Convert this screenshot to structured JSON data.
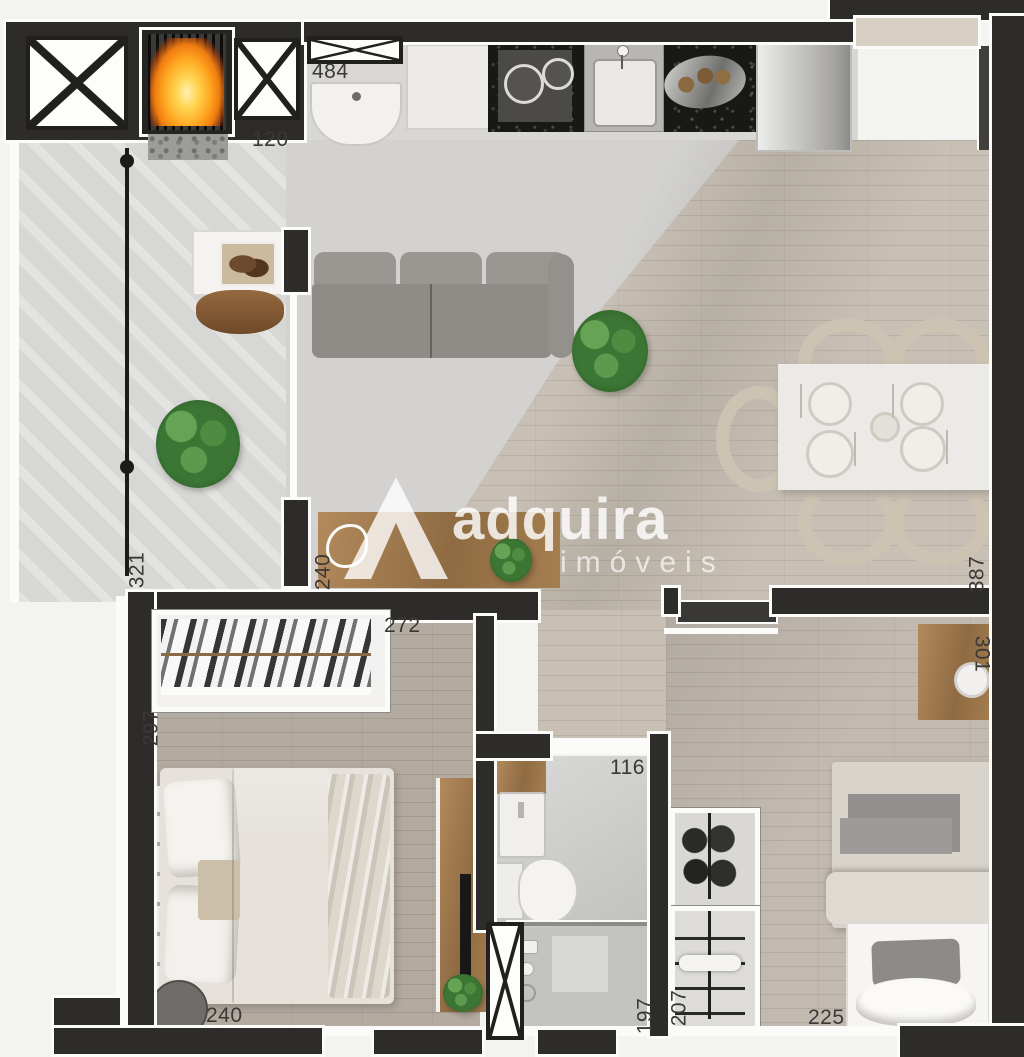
{
  "watermark": {
    "brand": "adquira",
    "tagline": "imóveis"
  },
  "labels": [
    {
      "text": "484",
      "orientation": "horizontal"
    },
    {
      "text": "120",
      "orientation": "horizontal"
    },
    {
      "text": "321",
      "orientation": "vertical"
    },
    {
      "text": "240",
      "orientation": "vertical"
    },
    {
      "text": "387",
      "orientation": "vertical"
    },
    {
      "text": "272",
      "orientation": "horizontal"
    },
    {
      "text": "297",
      "orientation": "vertical"
    },
    {
      "text": "116",
      "orientation": "horizontal"
    },
    {
      "text": "301",
      "orientation": "vertical"
    },
    {
      "text": "240",
      "orientation": "horizontal"
    },
    {
      "text": "197",
      "orientation": "vertical"
    },
    {
      "text": "207",
      "orientation": "vertical"
    },
    {
      "text": "225",
      "orientation": "horizontal"
    }
  ],
  "colors": {
    "wall": "#2d2c2a",
    "wood_floor": "#c8c0b4",
    "fire_accent": "#f59b1e",
    "plant_green": "#3c7635",
    "watermark_white": "#ffffff"
  }
}
